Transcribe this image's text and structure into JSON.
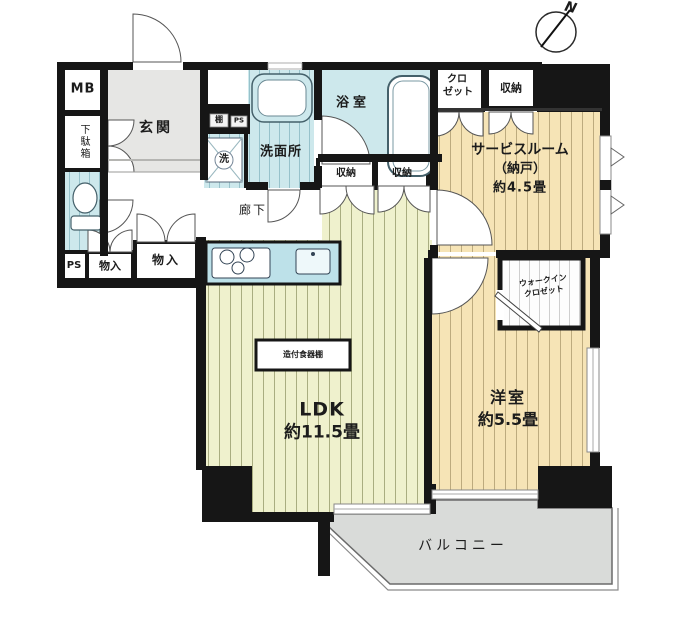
{
  "plan": {
    "compass_n": "N",
    "rooms": {
      "mb": "MB",
      "shoe_cabinet": "下駄箱",
      "entrance": "玄関",
      "shelf": "棚",
      "ps_upper": "PS",
      "washer": "洗",
      "washroom": "洗面所",
      "bathroom": "浴室",
      "closet_l1": "クロ",
      "closet_l2": "ゼット",
      "storage_top": "収納",
      "service_l1": "サービスルーム",
      "service_l2": "（納戸）",
      "service_l3": "約4.5畳",
      "storage_a": "収納",
      "storage_b": "収納",
      "ps_lower": "PS",
      "storage_left": "物入",
      "storage_mid": "物入",
      "corridor": "廊下",
      "wic_l1": "ウォークイン",
      "wic_l2": "クロゼット",
      "western_l1": "洋室",
      "western_l2": "約5.5畳",
      "ldk_l1": "LDK",
      "ldk_l2": "約11.5畳",
      "cupboard": "造付食器棚",
      "balcony": "バルコニー"
    },
    "colors": {
      "wall": "#161616",
      "wet_area": "#cde8ec",
      "ldk_floor": "#eff1cd",
      "bedroom_floor": "#f6e4b6",
      "entrance_floor": "#e6e6e4",
      "balcony": "#d9dbd9"
    }
  }
}
